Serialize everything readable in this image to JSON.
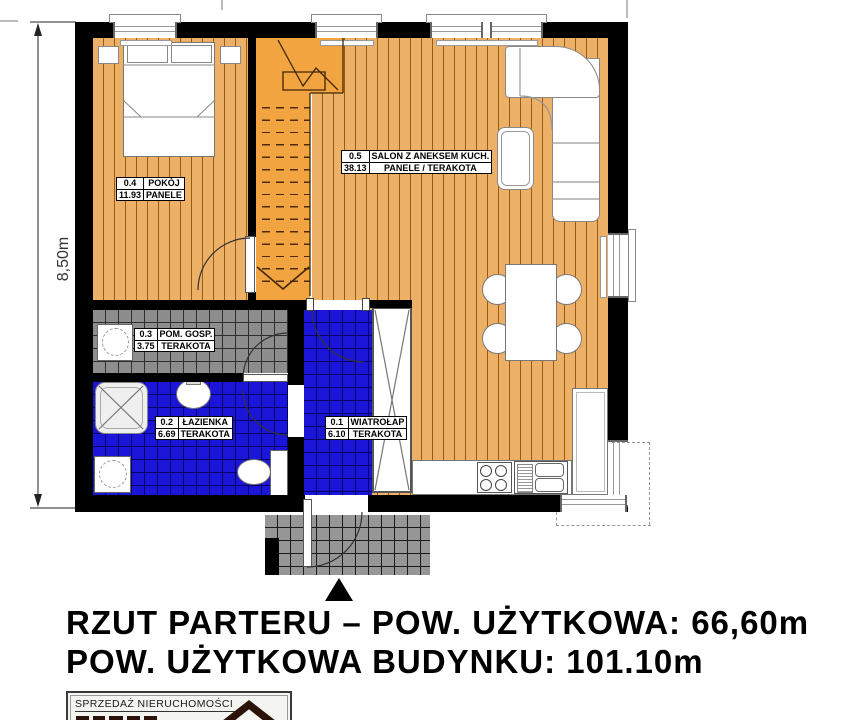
{
  "plan": {
    "dimension_label": "8,50m",
    "rooms": [
      {
        "id": "0.1",
        "name": "WIATROŁAP",
        "area": "6.10",
        "floor": "TERAKOTA"
      },
      {
        "id": "0.2",
        "name": "ŁAZIENKA",
        "area": "6.69",
        "floor": "TERAKOTA"
      },
      {
        "id": "0.3",
        "name": "POM. GOSP.",
        "area": "3.75",
        "floor": "TERAKOTA"
      },
      {
        "id": "0.4",
        "name": "POKÓJ",
        "area": "11.93",
        "floor": "PANELE"
      },
      {
        "id": "0.5",
        "name": "SALON Z ANEKSEM KUCH.",
        "area": "38.13",
        "floor": "PANELE / TERAKOTA"
      }
    ]
  },
  "title": {
    "line1": "RZUT PARTERU – POW. UŻYTKOWA: 66,60m",
    "line2": "POW. UŻYTKOWA BUDYNKU: 101.10m"
  },
  "logo": {
    "caption": "SPRZEDAŻ NIERUCHOMOŚCI"
  },
  "colors": {
    "wood_floor": "#edb067",
    "stairs": "#f1a440",
    "tile_blue": "#1b15d8",
    "tile_gray": "#8d8d8d",
    "porch": "#969696",
    "wall": "#000000",
    "logo_roof": "#2b130a"
  }
}
